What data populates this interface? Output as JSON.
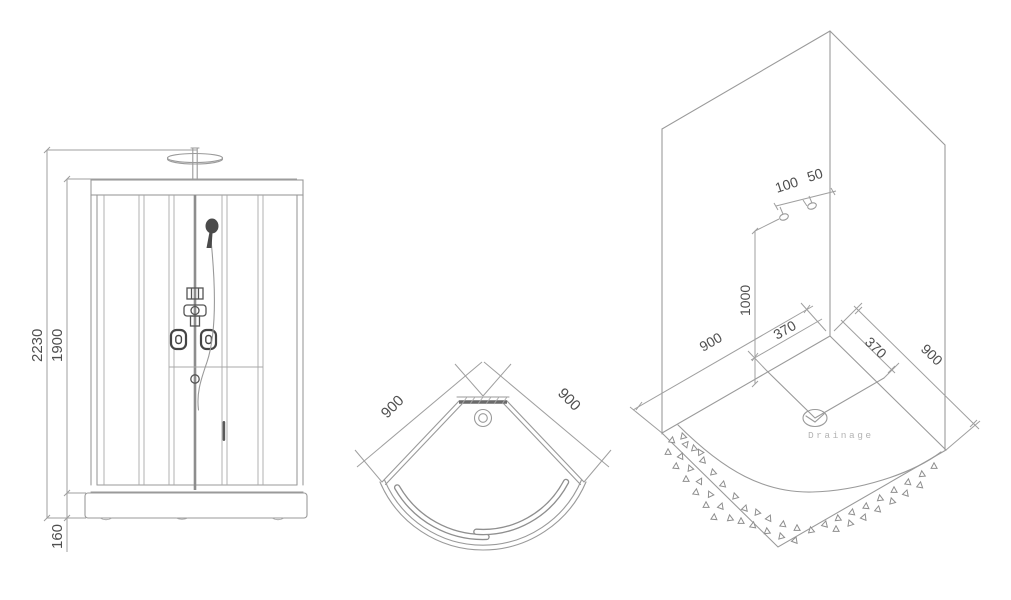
{
  "front_view": {
    "total_height": "2230",
    "cabin_height": "1900",
    "base_height": "160"
  },
  "plan_view": {
    "side_left": "900",
    "side_right": "900"
  },
  "iso_view": {
    "supply_spacing": "100",
    "supply_to_corner": "50",
    "supply_height": "1000",
    "wall_left": "900",
    "wall_right": "900",
    "drain_offset_left": "370",
    "drain_offset_right": "370",
    "drainage_label": "Drainage"
  },
  "colors": {
    "line": "#9a9a9a",
    "dim_text": "#4f4f4f",
    "dark_detail": "#4a4a4a",
    "drain_text": "#b4b4b4"
  }
}
